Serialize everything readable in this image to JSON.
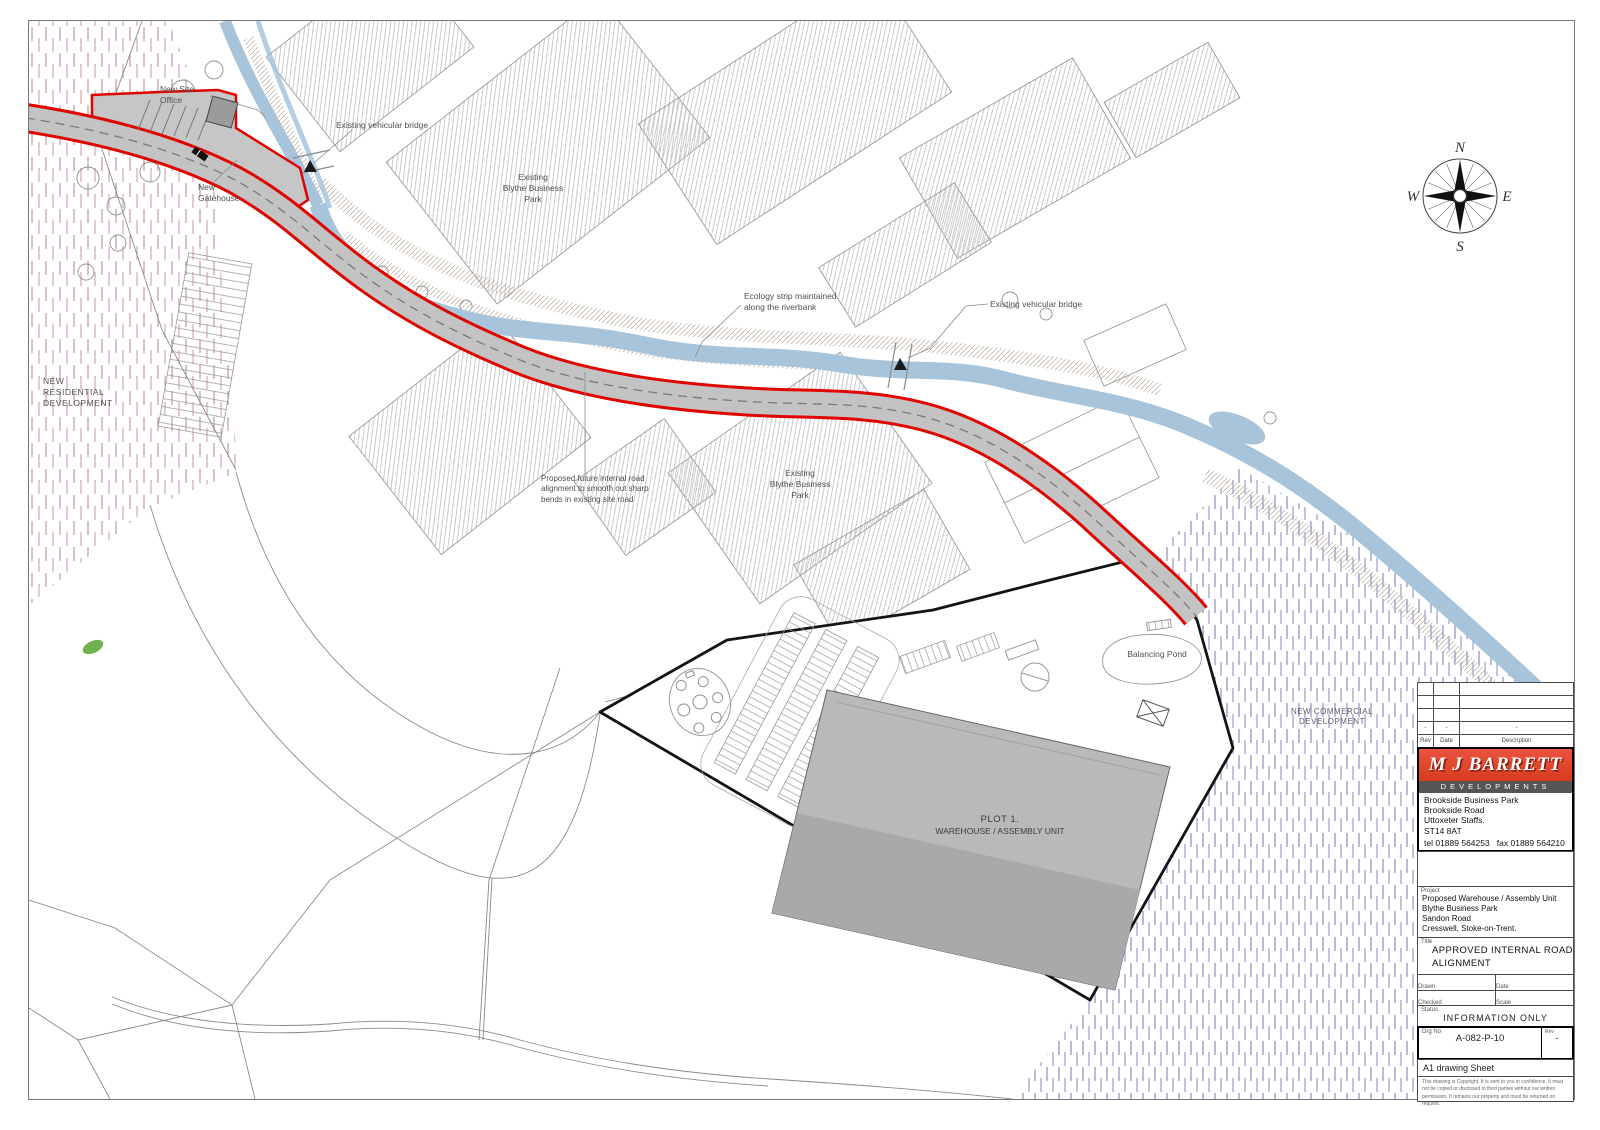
{
  "compass": {
    "n": "N",
    "e": "E",
    "s": "S",
    "w": "W"
  },
  "labels": {
    "new_site_office": [
      "New Site",
      "Office"
    ],
    "existing_bridge_1": "Existing vehicular bridge",
    "new_gatehouse": [
      "New",
      "Gatehouse"
    ],
    "blythe_park_1": [
      "Existing",
      "Blythe Business",
      "Park"
    ],
    "ecology_strip": [
      "Ecology strip maintained",
      "along the riverbank"
    ],
    "existing_bridge_2": "Existing vehicular bridge",
    "new_residential": [
      "NEW",
      "RESIDENTIAL",
      "DEVELOPMENT"
    ],
    "proposed_future_road": [
      "Proposed future internal road",
      "alignment to smooth out sharp",
      "bends in existing site road"
    ],
    "blythe_park_2": [
      "Existing",
      "Blythe Business",
      "Park"
    ],
    "balancing_pond": "Balancing Pond",
    "new_commercial": [
      "NEW COMMERCIAL",
      "DEVELOPMENT"
    ],
    "plot1": [
      "PLOT 1.",
      "WAREHOUSE / ASSEMBLY UNIT"
    ]
  },
  "title_block": {
    "revision": {
      "headers": {
        "rev": "Rev",
        "date": "Date",
        "description": "Description"
      },
      "row": {
        "rev": "-",
        "date": "-",
        "description": "-"
      }
    },
    "logo": {
      "company": "M J BARRETT",
      "division": "DEVELOPMENTS",
      "address": [
        "Brookside Business Park",
        "Brookside Road",
        "Uttoxeter Staffs.",
        "ST14 8AT"
      ],
      "phone": "tel 01889 564253   fax 01889 564210"
    },
    "project": {
      "label": "Project",
      "lines": [
        "Proposed Warehouse / Assembly Unit",
        "Blythe Business Park",
        "Sandon Road",
        "Cresswell, Stoke-on-Trent."
      ]
    },
    "title": {
      "label": "Title",
      "line1": "APPROVED INTERNAL ROAD",
      "line2": "ALIGNMENT"
    },
    "drawn": {
      "label": "Drawn",
      "value": "MCH"
    },
    "date": {
      "label": "Date",
      "value": "Sept 2018"
    },
    "checked": {
      "label": "Checked",
      "value": "-"
    },
    "scale": {
      "label": "Scale",
      "value": "1:800 @A1"
    },
    "status": {
      "label": "Status",
      "value": "INFORMATION ONLY"
    },
    "drg_no": {
      "label": "Drg No",
      "value": "A-082-P-10"
    },
    "rev": {
      "label": "Rev",
      "value": "-"
    },
    "sheet_note": "A1 drawing Sheet",
    "copyright": "This drawing is Copyright. It is sent to you in confidence. It must not be copied or disclosed to third parties without our written permission. It remains our property and must be returned on request."
  },
  "colors": {
    "boundary_red": "#e00400",
    "river_blue": "#a7c4da",
    "logo_red": "#e04a2e",
    "site_black": "#141414"
  }
}
